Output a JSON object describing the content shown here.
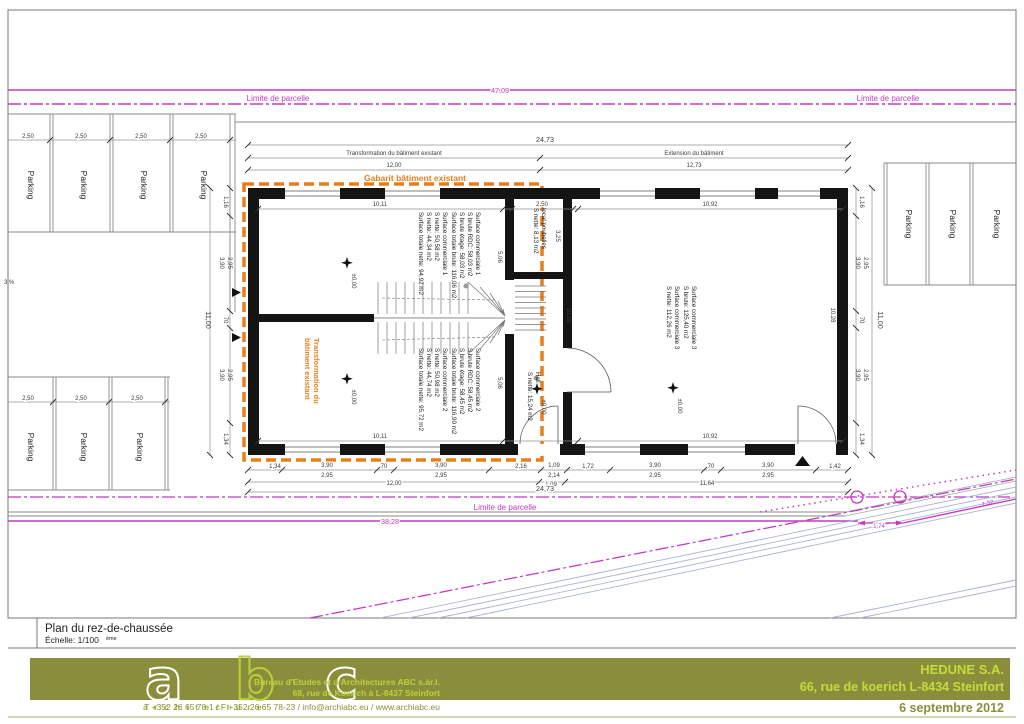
{
  "sheet": {
    "title": "Plan du rez-de-chaussée",
    "scale": "Échelle: 1/100",
    "scale_sup": "ème"
  },
  "site": {
    "limite": "Limite de parcelle",
    "dim_top": "47,09",
    "dim_road": "38,28",
    "dim_174": "1,74",
    "dim_132": "1,32",
    "slope": "3 %",
    "parking_label": "Parking",
    "stall_dim": "2,50"
  },
  "plan": {
    "gabarit": "Gabarit bâtiment existant",
    "transformation_l1": "Transformation du",
    "transformation_l2": "bâtiment existant",
    "level": "±0,00",
    "top_chain": {
      "overall": "24,73",
      "left_label": "Transformation du bâtiment existant",
      "right_label": "Extension du bâtiment",
      "left_dim": "12,00",
      "right_dim": "12,73"
    },
    "rooms": {
      "sc1": [
        "Surface commerciale 1",
        "S brute RDC: 58,03 m2",
        "S brute étage: 58,03 m2",
        "Surface totale brute: 116,06 m2",
        "Surface commerciale 1",
        "S nette: 50,58 m2",
        "S nette: 44,34 m2",
        "Surface totale nette: 94,92 m2"
      ],
      "sc2": [
        "Surface commerciale 2",
        "S brute RDC: 58,45 m2",
        "S brute étage: 58,45 m2",
        "Surface totale brute: 116,90 m2",
        "Surface commerciale 2",
        "S nette: 50,98 m2",
        "S nette: 44,74 m2",
        "Surface totale nette: 95,72 m2"
      ],
      "sc3": [
        "Surface commerciale 3",
        "S brute: 125,40 m2",
        "Surface commerciale 3",
        "S nette: 112,26 m2"
      ],
      "poubelles": [
        "local poubelles",
        "S nette: 8,13 m2"
      ],
      "hall": [
        "Hall",
        "S nette: 15,24 m2"
      ]
    },
    "dims": {
      "t1": "10,11",
      "t2": "2,50",
      "t3": "10,92",
      "b1": "10,11",
      "b2": "10,92",
      "v1028": "10,28",
      "v325": "3,25",
      "v506": "5,06",
      "c116": "1,16",
      "c390": "3,90",
      "c295": "2,95",
      "c70": "70",
      "c134": "1,34",
      "c1100": "11,00",
      "r216": "2,16",
      "r109": "1,09",
      "r214": "2,14",
      "r172": "1,72",
      "r142": "1,42",
      "row2_l": "12,00",
      "row2_m": "1,09",
      "row2_r": "11,64",
      "row3": "24,73"
    }
  },
  "footer": {
    "logo_a": "a",
    "logo_b": "b",
    "logo_c": "c",
    "logo_sub": "a r c h i t e c t u r e",
    "bureau1": "Bureau d'Etudes et d'Architectures ABC s.àr.l.",
    "bureau2": "68, rue de Koerich à L-8437 Steinfort",
    "contact": "T  +352 26 65 78-1 / F  +352 26 65 78-23 / info@archiabc.eu / www.archiabc.eu",
    "client": "HEDUNE S.A.",
    "client_address": "66, rue de koerich L-8434 Steinfort",
    "date": "6 septembre 2012"
  }
}
